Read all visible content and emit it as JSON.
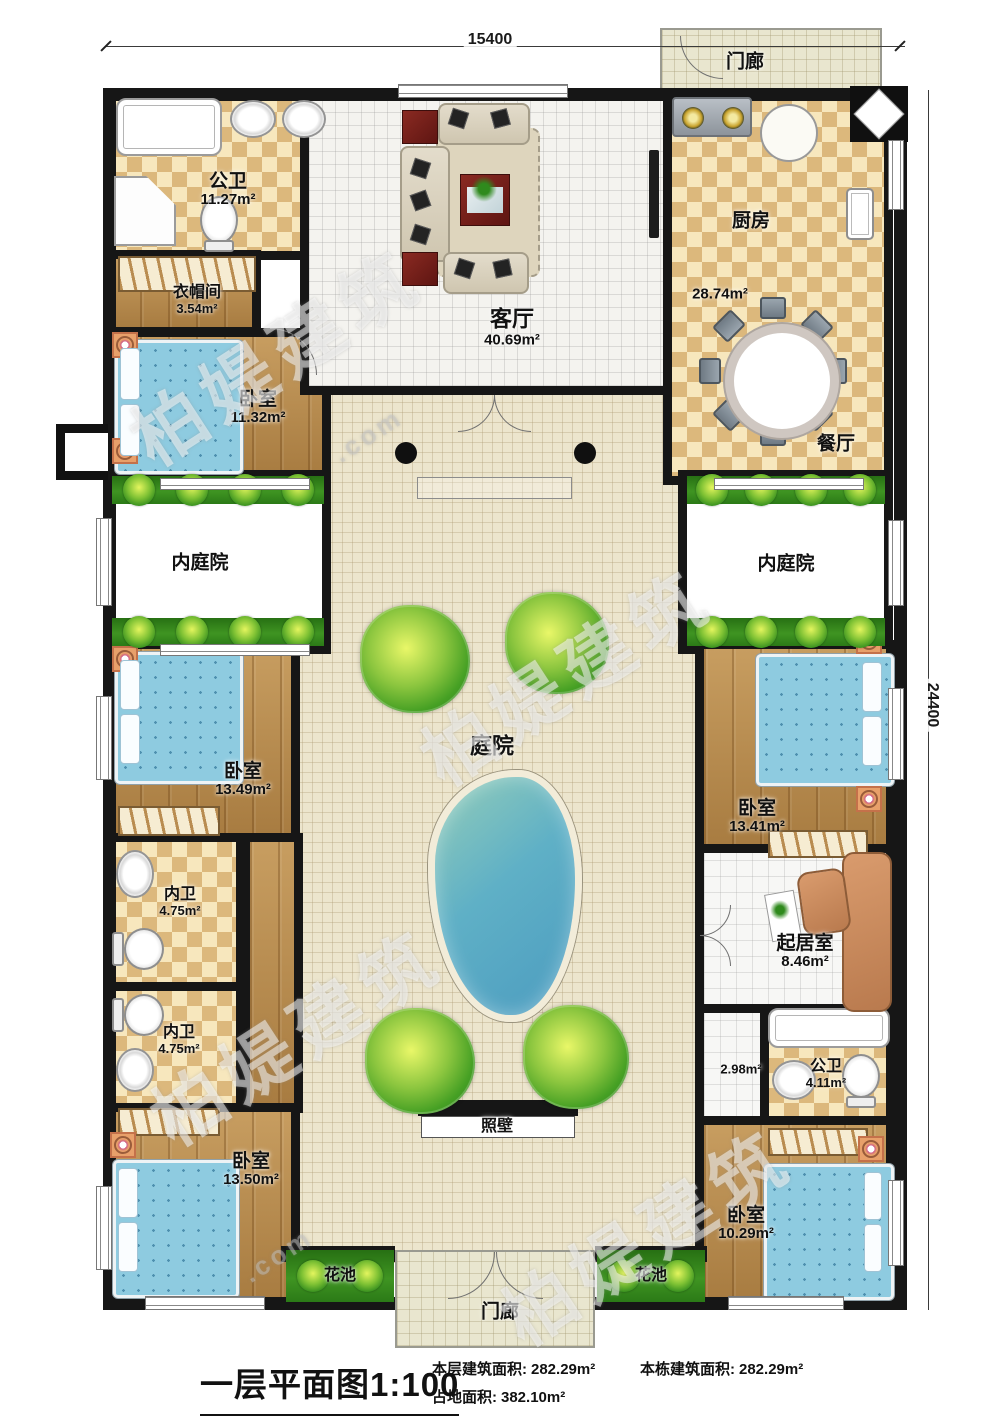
{
  "dimensions": {
    "top": "15400",
    "right": "24400"
  },
  "rooms": {
    "porch_top": {
      "name": "门廊"
    },
    "bath_top": {
      "name": "公卫",
      "area": "11.27m²"
    },
    "cloakroom": {
      "name": "衣帽间",
      "area": "3.54m²"
    },
    "bedroom_tl": {
      "name": "卧室",
      "area": "11.32m²"
    },
    "living": {
      "name": "客厅",
      "area": "40.69m²"
    },
    "kitchen": {
      "name": "厨房",
      "area": "28.74m²"
    },
    "dining": {
      "name": "餐厅"
    },
    "inner_court_left": {
      "name": "内庭院"
    },
    "inner_court_right": {
      "name": "内庭院"
    },
    "courtyard": {
      "name": "庭院"
    },
    "bedroom_ml": {
      "name": "卧室",
      "area": "13.49m²"
    },
    "bath_ml1": {
      "name": "内卫",
      "area": "4.75m²"
    },
    "bath_ml2": {
      "name": "内卫",
      "area": "4.75m²"
    },
    "bedroom_bl": {
      "name": "卧室",
      "area": "13.50m²"
    },
    "bedroom_mr": {
      "name": "卧室",
      "area": "13.41m²"
    },
    "sitting": {
      "name": "起居室",
      "area": "8.46m²"
    },
    "hall_small": {
      "area": "2.98m²"
    },
    "bath_br": {
      "name": "公卫",
      "area": "4.11m²"
    },
    "bedroom_br": {
      "name": "卧室",
      "area": "10.29m²"
    },
    "screen_wall": {
      "name": "照壁"
    },
    "flower_bed_left": {
      "name": "花池"
    },
    "flower_bed_right": {
      "name": "花池"
    },
    "porch_bottom": {
      "name": "门廊"
    }
  },
  "footer": {
    "title": "一层平面图1:100",
    "stats": [
      {
        "label": "本层建筑面积:",
        "value": "282.29m²"
      },
      {
        "label": "本栋建筑面积:",
        "value": "282.29m²"
      },
      {
        "label": "占地面积:",
        "value": "382.10m²"
      }
    ]
  },
  "watermark": {
    "brand": "柏媞建筑",
    "suffix": ".com"
  },
  "colors": {
    "wall": "#161616",
    "hedge": "#2f8a1d",
    "pool": "#5fb0c6",
    "checker": "#dcb87c",
    "wood": "#b9894c"
  }
}
